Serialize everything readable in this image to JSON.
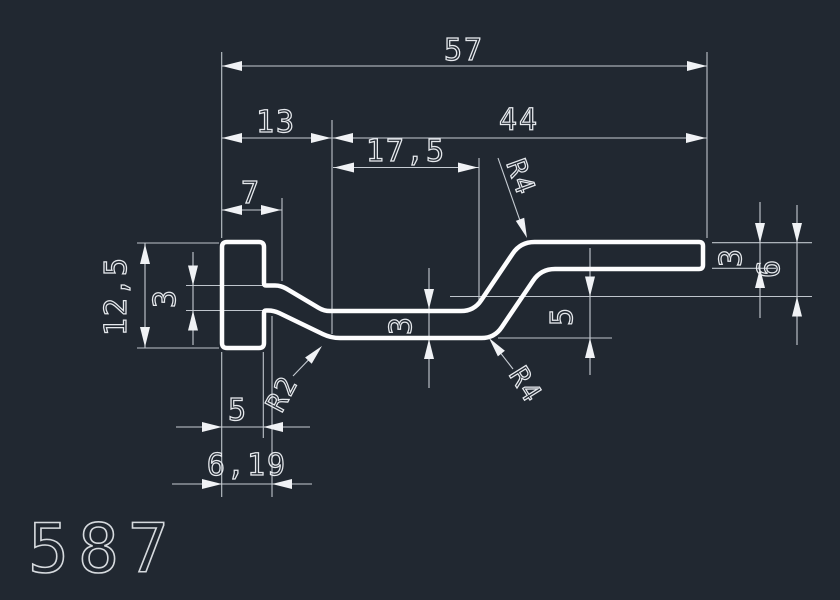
{
  "drawing": {
    "part_number": "587",
    "colors": {
      "background": "#212831",
      "profile_line": "#fdfdfe",
      "dimension_line": "#c6ccd3",
      "text": "#e6e9ed"
    },
    "dims": {
      "total_width": "57",
      "left_span": "13",
      "right_span": "44",
      "web_flat_length": "17,5",
      "head_depth": "7",
      "head_height": "12,5",
      "web_thickness_at_head": "3",
      "web_thickness_mid": "3",
      "flange_thickness": "3",
      "rise_height": "5",
      "flange_offset": "6",
      "head_width": "5",
      "head_to_slope": "6,19",
      "radius_top": "R4",
      "radius_bottom": "R4",
      "radius_left": "R2"
    }
  }
}
